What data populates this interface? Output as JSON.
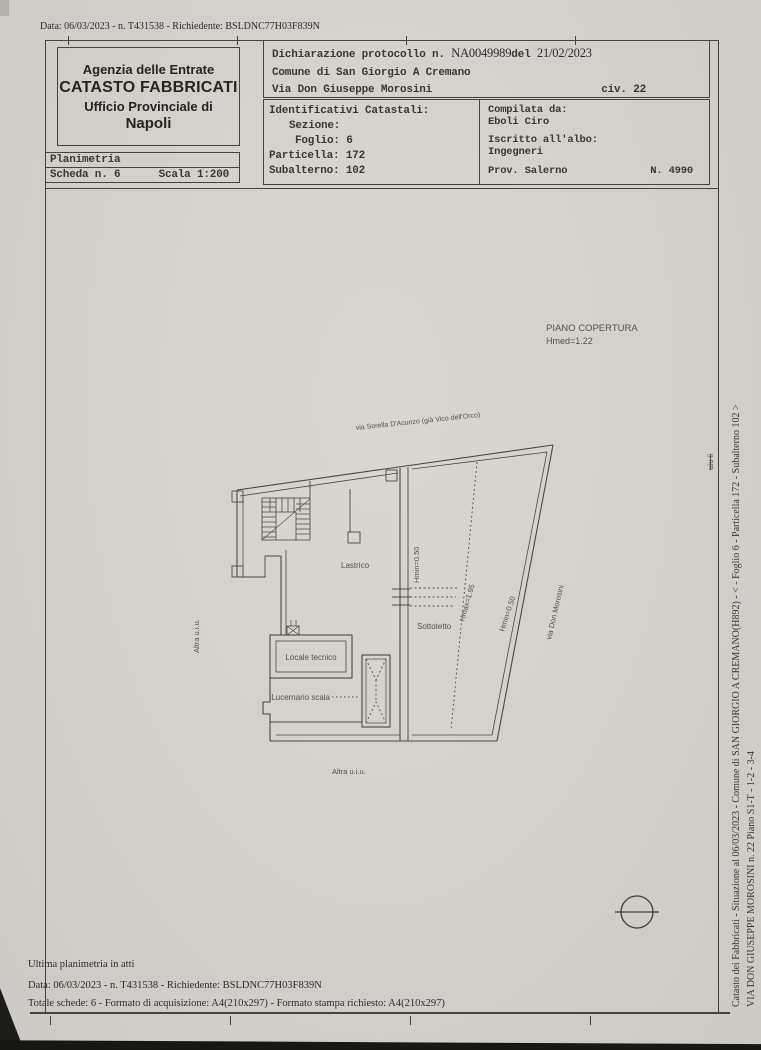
{
  "top_line": {
    "text": "Data: 06/03/2023 - n. T431538 - Richiedente: BSLDNC77H03F839N"
  },
  "header": {
    "agency": {
      "line1": "Agenzia delle Entrate",
      "line2": "CATASTO FABBRICATI",
      "line3": "Ufficio Provinciale di",
      "line4": "Napoli"
    },
    "planimetria": {
      "title": "Planimetria",
      "scheda": "Scheda n. 6",
      "scala": "Scala 1:200"
    },
    "declaration": {
      "label_protocollo": "Dichiarazione protocollo n.",
      "protocollo_value": "NA0049989",
      "label_del": "del",
      "date_value": "21/02/2023",
      "comune": "Comune di San Giorgio A Cremano",
      "via": "Via Don Giuseppe Morosini",
      "civico": "civ. 22"
    },
    "identifiers": {
      "title": "Identificativi Catastali:",
      "sezione": "Sezione:",
      "foglio": "Foglio: 6",
      "particella": "Particella: 172",
      "subalterno": "Subalterno: 102"
    },
    "compiler": {
      "label": "Compilata da:",
      "name": "Eboli Ciro",
      "albo_label": "Iscritto all'albo:",
      "albo": "Ingegneri",
      "prov": "Prov. Salerno",
      "number": "N. 4990"
    }
  },
  "plan": {
    "title": "PIANO COPERTURA",
    "subtitle": "Hmed=1.22",
    "street_top": "via Sorella D'Acunzo (già Vico dell'Orco)",
    "street_right": "via Don Morosini",
    "labels": {
      "lastrico": "Lastrico",
      "sottotetto": "Sottotetto",
      "hmin_divider": "Hmin=0.50",
      "hmax": "Hmax=1.95",
      "hmin_right": "Hmin=0.50",
      "locale_tecnico": "Locale tecnico",
      "lucernario": "Lucernario scala",
      "altra_left": "Altra u.i.u.",
      "altra_bottom": "Altra u.i.u."
    }
  },
  "margin_right": {
    "line1": "Catasto dei Fabbricati - Situazione al 06/03/2023 - Comune di SAN GIORGIO A CREMANO(H892) - < - Foglio 6 - Particella 172 - Subalterno 102 >",
    "line2": "VIA DON GIUSEPPE MOROSINI n. 22 Piano S1-T - 1-2 - 3-4",
    "struck": "uiu 6"
  },
  "footer": {
    "line1": "Ultima planimetria in atti",
    "line2": "Data: 06/03/2023 - n. T431538 - Richiedente: BSLDNC77H03F839N",
    "line3": "Totale schede: 6 - Formato di acquisizione: A4(210x297)  - Formato stampa richiesto: A4(210x297)"
  },
  "colors": {
    "paper": "#d7d4cf",
    "ink": "#3b3833",
    "plan_line": "#4a4841"
  }
}
